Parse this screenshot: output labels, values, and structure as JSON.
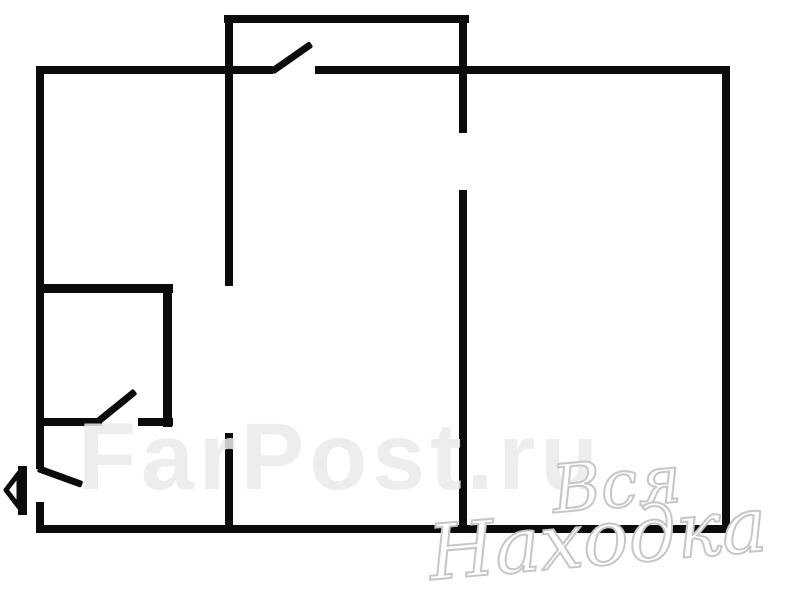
{
  "floorplan": {
    "background_color": "#ffffff",
    "wall_color": "#0b0b0b",
    "walls": [
      {
        "name": "balcony-top-wall",
        "x": 224,
        "y": 15,
        "w": 245,
        "h": 8
      },
      {
        "name": "outer-top-wall-left",
        "x": 36,
        "y": 66,
        "w": 237,
        "h": 8
      },
      {
        "name": "outer-top-wall-right",
        "x": 315,
        "y": 66,
        "w": 415,
        "h": 8
      },
      {
        "name": "outer-left-wall-upper",
        "x": 36,
        "y": 66,
        "w": 8,
        "h": 403
      },
      {
        "name": "outer-left-wall-lower",
        "x": 36,
        "y": 502,
        "w": 8,
        "h": 31
      },
      {
        "name": "outer-bottom-wall",
        "x": 36,
        "y": 525,
        "w": 694,
        "h": 8
      },
      {
        "name": "outer-right-wall",
        "x": 722,
        "y": 66,
        "w": 8,
        "h": 467
      },
      {
        "name": "hall-partition-upper",
        "x": 225,
        "y": 15,
        "w": 8,
        "h": 271
      },
      {
        "name": "hall-partition-lower",
        "x": 225,
        "y": 433,
        "w": 8,
        "h": 100
      },
      {
        "name": "room-partition-upper",
        "x": 459,
        "y": 15,
        "w": 8,
        "h": 118
      },
      {
        "name": "room-partition-lower",
        "x": 459,
        "y": 190,
        "w": 8,
        "h": 343
      },
      {
        "name": "bathroom-top-wall",
        "x": 36,
        "y": 284,
        "w": 137,
        "h": 9
      },
      {
        "name": "bathroom-right-wall",
        "x": 163,
        "y": 284,
        "w": 9,
        "h": 143
      },
      {
        "name": "bathroom-bottom-wall-left",
        "x": 36,
        "y": 418,
        "w": 66,
        "h": 8
      },
      {
        "name": "bathroom-bottom-wall-right",
        "x": 138,
        "y": 418,
        "w": 35,
        "h": 8
      }
    ],
    "doors": [
      {
        "name": "balcony-door-leaf",
        "x": 272,
        "y": 71,
        "len": 48,
        "angle": -35,
        "thickness": 7
      },
      {
        "name": "bathroom-door-leaf",
        "x": 98,
        "y": 421,
        "len": 48,
        "angle": -39,
        "thickness": 7
      },
      {
        "name": "entrance-door-leaf",
        "x": 38,
        "y": 468,
        "len": 47,
        "angle": 20,
        "thickness": 7
      }
    ],
    "entrance_arrow": {
      "direction": "left",
      "x": 3,
      "y": 464
    }
  },
  "watermarks": {
    "background_text": "FarPost.ru",
    "background_color": "#eaeaea",
    "script_line1": "Вся",
    "script_line2": "Находка",
    "script_color": "#c6c6c6"
  }
}
